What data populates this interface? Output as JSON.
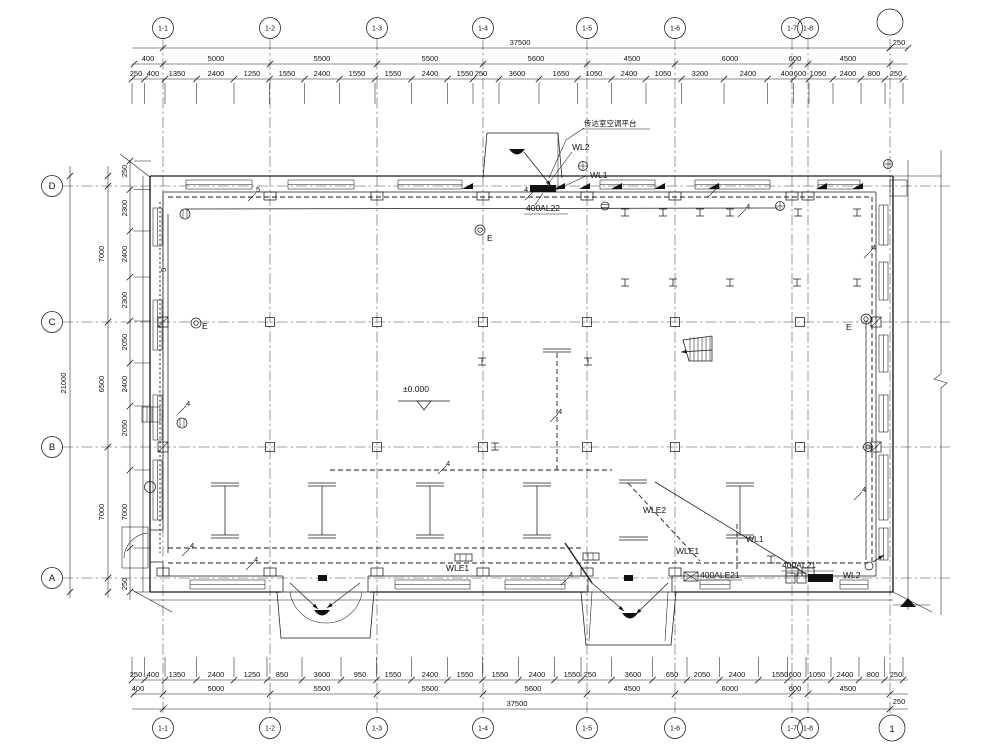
{
  "drawing": {
    "type": "electrical-floor-plan",
    "level_mark": "±0.000",
    "platform_note": "传达室空调平台"
  },
  "axes": {
    "top": [
      "1-1",
      "1-2",
      "1-3",
      "1-4",
      "1-5",
      "1-6",
      "1-7",
      "1-8"
    ],
    "left": [
      "D",
      "C",
      "B",
      "A"
    ],
    "right_bottom": "1"
  },
  "dims": {
    "top": {
      "total": "37500",
      "row2": [
        "400",
        "5000",
        "5500",
        "5500",
        "5600",
        "4500",
        "6000",
        "600",
        "4500"
      ],
      "detail": [
        "250",
        "400",
        "1350",
        "2400",
        "1250",
        "1550",
        "2400",
        "1550",
        "1550",
        "2400",
        "1550",
        "250",
        "3600",
        "1650",
        "1050",
        "2400",
        "1050",
        "3200",
        "2400",
        "400",
        "600",
        "1050",
        "2400",
        "800",
        "250"
      ],
      "right250": "250"
    },
    "bottom": {
      "total": "37500",
      "row2": [
        "400",
        "5000",
        "5500",
        "5500",
        "5600",
        "4500",
        "6000",
        "600",
        "4500"
      ],
      "detail": [
        "250",
        "400",
        "1350",
        "2400",
        "1250",
        "850",
        "3600",
        "950",
        "1550",
        "2400",
        "1550",
        "1550",
        "2400",
        "1550",
        "250",
        "3600",
        "650",
        "2050",
        "2400",
        "1550",
        "600",
        "1050",
        "2400",
        "800",
        "250"
      ],
      "right250": "250"
    },
    "left": {
      "total": "21000",
      "row2": [
        "7000",
        "6500",
        "7000"
      ],
      "detail": [
        "250",
        "2300",
        "2400",
        "2300",
        "2050",
        "2400",
        "2050",
        "7000",
        "250"
      ]
    }
  },
  "labels": {
    "wl1": "WL1",
    "wl2": "WL2",
    "wle1": "WLE1",
    "wle2": "WLE2",
    "al22": "400AL22",
    "al21": "400AL21",
    "ale21": "400ALE21",
    "emergency": "E",
    "c4": "4",
    "c5": "5",
    "level": "±0.000"
  }
}
